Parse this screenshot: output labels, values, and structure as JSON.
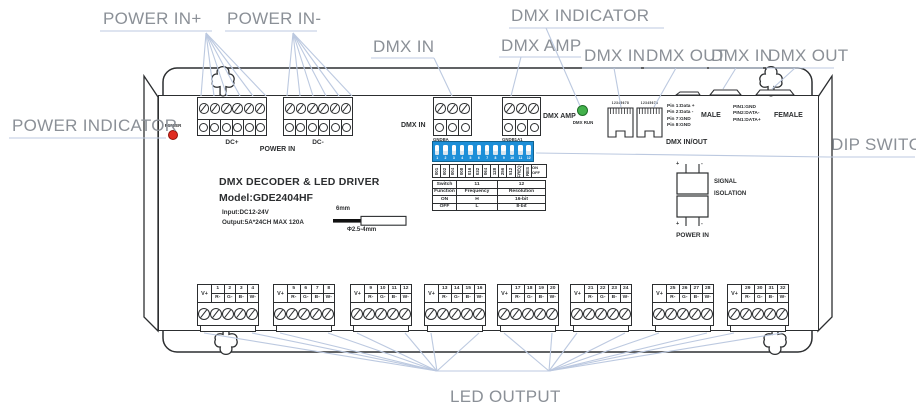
{
  "colors": {
    "callout_text": "#8b9097",
    "callout_line": "#bcc9e0",
    "line_art": "#2c2e30",
    "dip_blue": "#1d8fd8",
    "power_led_red": "#e02b20",
    "dmx_led_green": "#43b14b"
  },
  "callouts": {
    "power_in_plus": "POWER IN+",
    "power_in_minus": "POWER IN-",
    "dmx_in": "DMX IN",
    "dmx_amp": "DMX AMP",
    "dmx_indicator": "DMX INDICATOR",
    "dmx_in_1": "DMX IN",
    "dmx_out_1": "DMX OUT",
    "dmx_in_2": "DMX IN",
    "dmx_out_2": "DMX OUT",
    "power_indicator": "POWER INDICATOR",
    "dip_switch": "DIP SWITCH",
    "led_output": "LED OUTPUT"
  },
  "panel": {
    "title": "DMX DECODER & LED DRIVER",
    "model": "Model:GDE2404HF",
    "input": "Input:DC12-24V",
    "output": "Output:5A*24CH MAX 120A",
    "power_led": "POWER",
    "dmx_run": "DMX RUN",
    "dc_plus": "DC+",
    "dc_minus": "DC-",
    "power_in": "POWER IN",
    "dmx_in_label": "DMX IN",
    "dmx_in_pins": [
      "GND",
      "B",
      "A"
    ],
    "dmx_amp_label": "DMX AMP",
    "dmx_amp_pins": [
      "GND",
      "B1",
      "A1"
    ],
    "rj45": {
      "pin_numbers": "12345678",
      "male_pins": [
        "Pin 1:Data +",
        "Pin 2:Data -",
        "Pin 7:GND",
        "Pin 8:GND"
      ],
      "male": "MALE",
      "female_pins": [
        "PIN1:GND",
        "PIN2:DATA-",
        "PIN1:DATA+"
      ],
      "female": "FEMALE",
      "caption": "DMX IN/OUT"
    },
    "dip": {
      "numbers": [
        "1",
        "2",
        "3",
        "4",
        "5",
        "6",
        "7",
        "8",
        "9",
        "10",
        "11",
        "12"
      ],
      "values": [
        "001",
        "002",
        "004",
        "008",
        "016",
        "032",
        "064",
        "128",
        "256",
        "512",
        "FREQ",
        "RES"
      ],
      "on": "ON",
      "off": "OFF"
    },
    "dip_table": [
      [
        "Switch",
        "11",
        "12"
      ],
      [
        "Function",
        "Frequency",
        "Resolution"
      ],
      [
        "ON",
        "H",
        "16-bit"
      ],
      [
        "OFF",
        "L",
        "8-bit"
      ]
    ],
    "wire": {
      "length": "6mm",
      "diameter": "Φ2.5-4mm"
    },
    "isolation": {
      "signal": "SIGNAL",
      "isolation": "ISOLATION",
      "power_in": "POWER IN",
      "plus": "+",
      "minus": "-"
    },
    "outputs": {
      "v_plus": "V+",
      "rgbw": [
        "R-",
        "G-",
        "B-",
        "W-"
      ],
      "groups": [
        [
          "1",
          "2",
          "3",
          "4"
        ],
        [
          "5",
          "6",
          "7",
          "8"
        ],
        [
          "9",
          "10",
          "11",
          "12"
        ],
        [
          "13",
          "14",
          "15",
          "16"
        ],
        [
          "17",
          "18",
          "19",
          "20"
        ],
        [
          "21",
          "22",
          "23",
          "24"
        ],
        [
          "25",
          "26",
          "27",
          "28"
        ],
        [
          "29",
          "30",
          "31",
          "32"
        ]
      ]
    }
  }
}
